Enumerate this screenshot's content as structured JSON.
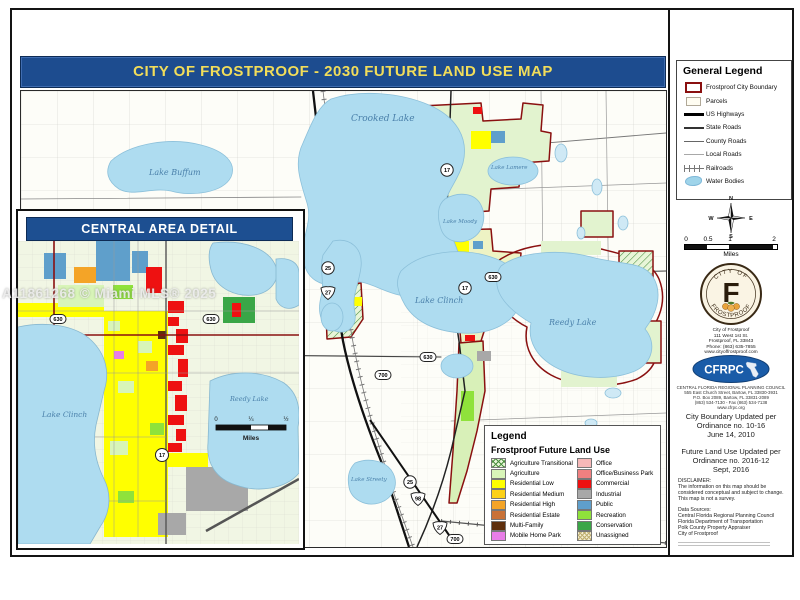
{
  "watermark": "A11861268 © Miami MLS® 2025",
  "title_banner": {
    "text": "CITY OF FROSTPROOF - 2030 FUTURE LAND USE MAP"
  },
  "colors": {
    "banner_blue": "#1d4c8f",
    "banner_text": "#f2dd5a",
    "inset_band_blue": "#1d4f91",
    "water": "#aedcf0",
    "city_boundary_red": "#8a1010",
    "commercial_red": "#ee1111",
    "public_blue": "#5f9fcb",
    "agriculture_green": "#d8f5b8",
    "residential_yellow": "#ffff00"
  },
  "general_legend": {
    "title": "General Legend",
    "items": [
      {
        "label": "Frostproof City Boundary",
        "symbol": "sym-boundary"
      },
      {
        "label": "Parcels",
        "symbol": "sym-parcel"
      },
      {
        "label": "US Highways",
        "symbol": "sym-us-highway"
      },
      {
        "label": "State Roads",
        "symbol": "sym-state-road"
      },
      {
        "label": "County Roads",
        "symbol": "sym-county-road"
      },
      {
        "label": "Local Roads",
        "symbol": "sym-local-road"
      },
      {
        "label": "Railroads",
        "symbol": "sym-railroad"
      },
      {
        "label": "Water Bodies",
        "symbol": "sym-water"
      }
    ]
  },
  "compass": {
    "n": "N",
    "e": "E",
    "s": "S",
    "w": "W"
  },
  "scalebar": {
    "ticks": [
      "0",
      "0.5",
      "1",
      "2"
    ],
    "unit": "Miles"
  },
  "city_seal": {
    "arc_top": "CITY OF",
    "monogram": "F",
    "arc_bottom": "FROSTPROOF"
  },
  "city_contact": [
    "City of Frostproof",
    "111 West 1st St.",
    "Frostproof, FL 33843",
    "Phone: (863) 635-7855",
    "www.cityoffrostproof.com"
  ],
  "cfrpc": {
    "acronym": "CFRPC",
    "address_lines": [
      "CENTRAL FLORIDA REGIONAL PLANNING COUNCIL",
      "555 East Church Street, Bartow, FL 33830-3931",
      "P.O. Box 2089, Bartow, FL 33831-2089",
      "(863) 534-7130 - Fax (863) 534-7138",
      "www.cfrpc.org"
    ]
  },
  "updates": {
    "boundary": [
      "City Boundary Updated per",
      "Ordinance no. 10-16",
      "June 14, 2010"
    ],
    "land_use": [
      "Future Land Use Updated per",
      "Ordinance no. 2016-12",
      "Sept, 2016"
    ]
  },
  "disclaimer": {
    "heading": "DISCLAIMER:",
    "lines": [
      "The information on this map should be",
      "considered conceptual and subject to change.",
      "This map is not a survey."
    ]
  },
  "data_sources": {
    "heading": "Data Sources:",
    "lines": [
      "Central Florida Regional Planning Council",
      "Florida Department of Transportation",
      "Polk County Property Appraiser",
      "City of Frostproof"
    ]
  },
  "flu_legend": {
    "title": "Legend",
    "subtitle": "Frostproof Future Land Use",
    "left": [
      {
        "label": "Agriculture Transitional",
        "color": "#e8f5d8",
        "hatch": "green"
      },
      {
        "label": "Agriculture",
        "color": "#d8f5b8"
      },
      {
        "label": "Residential Low",
        "color": "#ffff00"
      },
      {
        "label": "Residential Medium",
        "color": "#fcd116"
      },
      {
        "label": "Residential High",
        "color": "#f4a427"
      },
      {
        "label": "Residential Estate",
        "color": "#c87137"
      },
      {
        "label": "Multi-Family",
        "color": "#5e2f0d"
      },
      {
        "label": "Mobile Home Park",
        "color": "#e87ee8"
      }
    ],
    "right": [
      {
        "label": "Office",
        "color": "#f6b8b8"
      },
      {
        "label": "Office/Business Park",
        "color": "#f08080"
      },
      {
        "label": "Commercial",
        "color": "#ee1111"
      },
      {
        "label": "Industrial",
        "color": "#a8a8a8"
      },
      {
        "label": "Public",
        "color": "#5f9fcb"
      },
      {
        "label": "Recreation",
        "color": "#8fe23b"
      },
      {
        "label": "Conservation",
        "color": "#3aa647"
      },
      {
        "label": "Unassigned",
        "color": "#f4eed2",
        "hatch": "tan"
      }
    ]
  },
  "inset": {
    "title": "CENTRAL AREA DETAIL",
    "labels": {
      "lake_clinch": "Lake Clinch",
      "reedy_lake": "Reedy Lake"
    },
    "scalebar": {
      "ticks": [
        "0",
        "¼",
        "½"
      ],
      "unit": "Miles"
    }
  },
  "map": {
    "labels": {
      "crooked_lake": "Crooked Lake",
      "lake_buffum": "Lake Buffum",
      "lake_lamere": "Lake Lamere",
      "lake_moody": "Lake Moody",
      "lake_clinch": "Lake Clinch",
      "reedy_lake": "Reedy Lake",
      "lake_streety": "Lake Streety"
    },
    "shields": {
      "s17": "17",
      "s25": "25",
      "s27": "27",
      "s98": "98",
      "s630": "630",
      "s700": "700"
    }
  }
}
